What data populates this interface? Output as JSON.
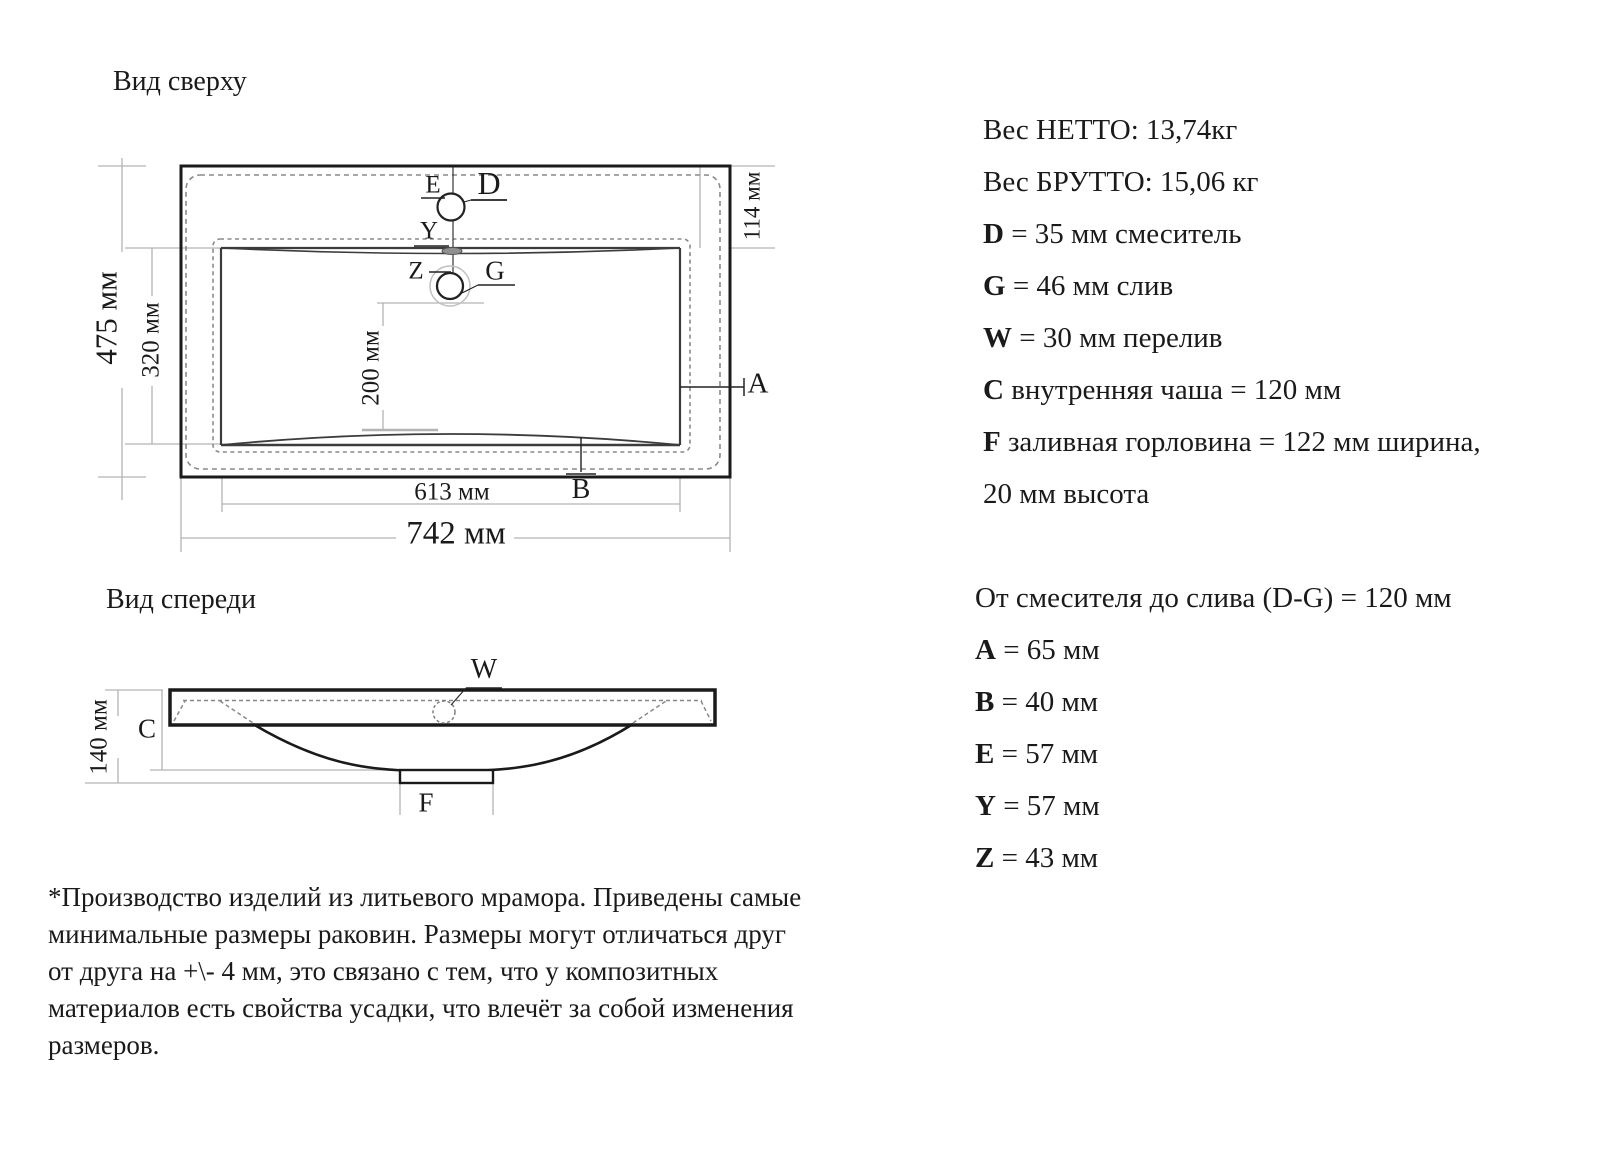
{
  "top_view": {
    "title": "Вид сверху",
    "dim_height_outer": "475 мм",
    "dim_height_inner": "320 мм",
    "dim_offset_top": "114 мм",
    "dim_drain_to_edge": "200 мм",
    "dim_width_inner": "613 мм",
    "dim_width_outer": "742 мм",
    "label_e": "E",
    "label_d": "D",
    "label_y": "Y",
    "label_z": "Z",
    "label_g": "G",
    "label_a": "A",
    "label_b": "B"
  },
  "front_view": {
    "title": "Вид спереди",
    "dim_height": "140 мм",
    "label_c": "C",
    "label_w": "W",
    "label_f": "F"
  },
  "specs_primary": {
    "lines": [
      {
        "bold": "",
        "rest": "Вес НЕТТО: 13,74кг"
      },
      {
        "bold": "",
        "rest": "Вес БРУТТО: 15,06 кг"
      },
      {
        "bold": "D",
        "rest": " = 35 мм смеситель"
      },
      {
        "bold": "G",
        "rest": " = 46 мм слив"
      },
      {
        "bold": "W",
        "rest": " = 30 мм перелив"
      },
      {
        "bold": "C",
        "rest": " внутренняя чаша = 120 мм"
      },
      {
        "bold": "F",
        "rest": " заливная горловина = 122 мм ширина,"
      },
      {
        "bold": "",
        "rest": "20 мм высота"
      }
    ]
  },
  "specs_secondary": {
    "lines": [
      {
        "bold": "",
        "rest": "От смесителя до слива (D-G) = 120 мм"
      },
      {
        "bold": "A",
        "rest": " = 65 мм"
      },
      {
        "bold": "B",
        "rest": " = 40 мм"
      },
      {
        "bold": "E",
        "rest": " = 57 мм"
      },
      {
        "bold": "Y",
        "rest": " = 57 мм"
      },
      {
        "bold": "Z",
        "rest": " = 43 мм"
      }
    ]
  },
  "footnote": {
    "lines": [
      "*Производство изделий из литьевого мрамора. Приведены самые",
      "минимальные размеры раковин. Размеры могут отличаться друг",
      "от друга на +\\- 4 мм, это связано с тем, что у композитных",
      "материалов есть свойства усадки, что влечёт за собой изменения",
      "размеров."
    ]
  },
  "colors": {
    "ink": "#1a1a1a",
    "dimension_gray": "#b3b3b3",
    "hidden_line_gray": "#888888"
  }
}
